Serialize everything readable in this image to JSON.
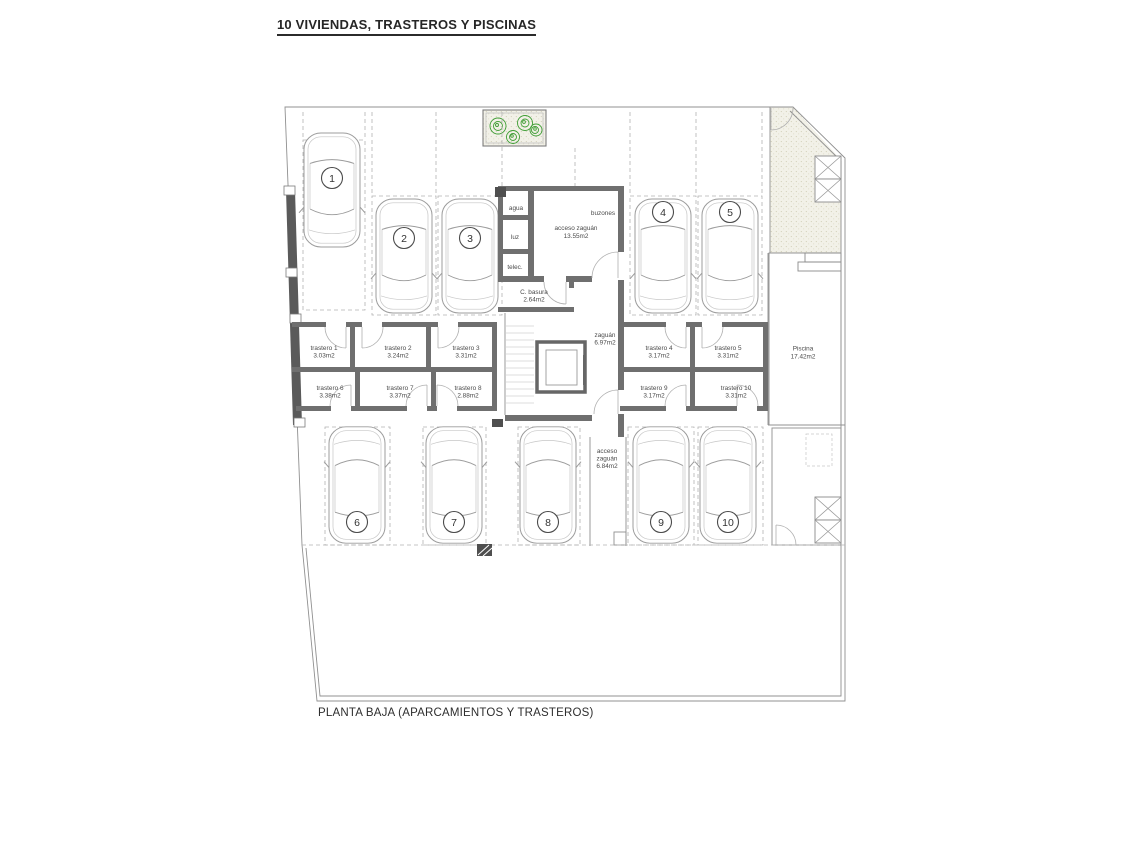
{
  "title": "10 VIVIENDAS, TRASTEROS Y PISCINAS",
  "caption": "PLANTA BAJA (APARCAMIENTOS Y TRASTEROS)",
  "parking": {
    "spaces": [
      {
        "number": "1"
      },
      {
        "number": "2"
      },
      {
        "number": "3"
      },
      {
        "number": "4"
      },
      {
        "number": "5"
      },
      {
        "number": "6"
      },
      {
        "number": "7"
      },
      {
        "number": "8"
      },
      {
        "number": "9"
      },
      {
        "number": "10"
      }
    ]
  },
  "trasteros": [
    {
      "label": "trastero 1",
      "area": "3.03m2"
    },
    {
      "label": "trastero 2",
      "area": "3.24m2"
    },
    {
      "label": "trastero 3",
      "area": "3.31m2"
    },
    {
      "label": "trastero 4",
      "area": "3.17m2"
    },
    {
      "label": "trastero 5",
      "area": "3.31m2"
    },
    {
      "label": "trastero 6",
      "area": "3.38m2"
    },
    {
      "label": "trastero 7",
      "area": "3.37m2"
    },
    {
      "label": "trastero 8",
      "area": "2.88m2"
    },
    {
      "label": "trastero 9",
      "area": "3.17m2"
    },
    {
      "label": "trastero 10",
      "area": "3.31m2"
    }
  ],
  "utilities": {
    "agua": "agua",
    "luz": "luz",
    "telec": "telec.",
    "buzones": "buzones"
  },
  "rooms": {
    "acceso_top": {
      "line1": "acceso zaguán",
      "line2": "13.55m2"
    },
    "basura": {
      "line1": "C. basura",
      "line2": "2.64m2"
    },
    "zaguan": {
      "line1": "zaguán",
      "line2": "6.97m2"
    },
    "acceso_bottom": {
      "line1": "acceso",
      "line2": "zaguán",
      "line3": "6.84m2"
    },
    "piscina": {
      "line1": "Piscina",
      "line2": "17.42m2"
    }
  },
  "colors": {
    "pool": "#b9e2f1",
    "plant": "#3f9e35"
  }
}
